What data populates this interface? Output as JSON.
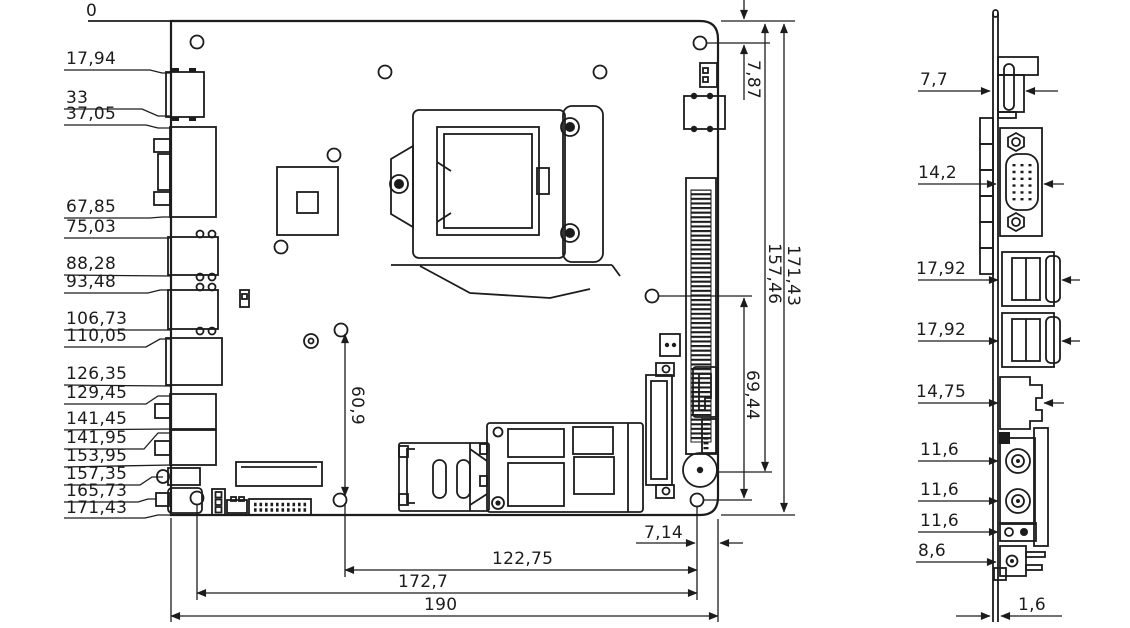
{
  "colors": {
    "background": "#ffffff",
    "ink": "#1c1c1c"
  },
  "main_view": {
    "name": "motherboard top view drawing",
    "origin_label": "0",
    "left_dims": [
      "17,94",
      "33",
      "37,05",
      "67,85",
      "75,03",
      "88,28",
      "93,48",
      "106,73",
      "110,05",
      "126,35",
      "129,45",
      "141,45",
      "141,95",
      "153,95",
      "157,35",
      "165,73",
      "171,43"
    ],
    "vertical_dims": {
      "hole_offset_top": "7,87",
      "board_height": "171,43",
      "inner_height": "157,46",
      "hole_span_right": "69,44",
      "hole_span_left": "60,9"
    },
    "bottom_dims": {
      "hole_edge_offset": "7,14",
      "hole_span": "122,75",
      "hole_span_wide": "172,7",
      "board_width": "190"
    }
  },
  "side_view": {
    "name": "rear IO side view drawing",
    "dims": {
      "hdmi_depth": "7,7",
      "vga_depth": "14,2",
      "usb_top_depth": "17,92",
      "usb_bottom_depth": "17,92",
      "lan_depth": "14,75",
      "audio_jack1_depth": "11,6",
      "audio_jack2_depth": "11,6",
      "connector_depth": "11,6",
      "dc_jack_depth": "8,6",
      "pcb_thickness": "1,6"
    }
  }
}
